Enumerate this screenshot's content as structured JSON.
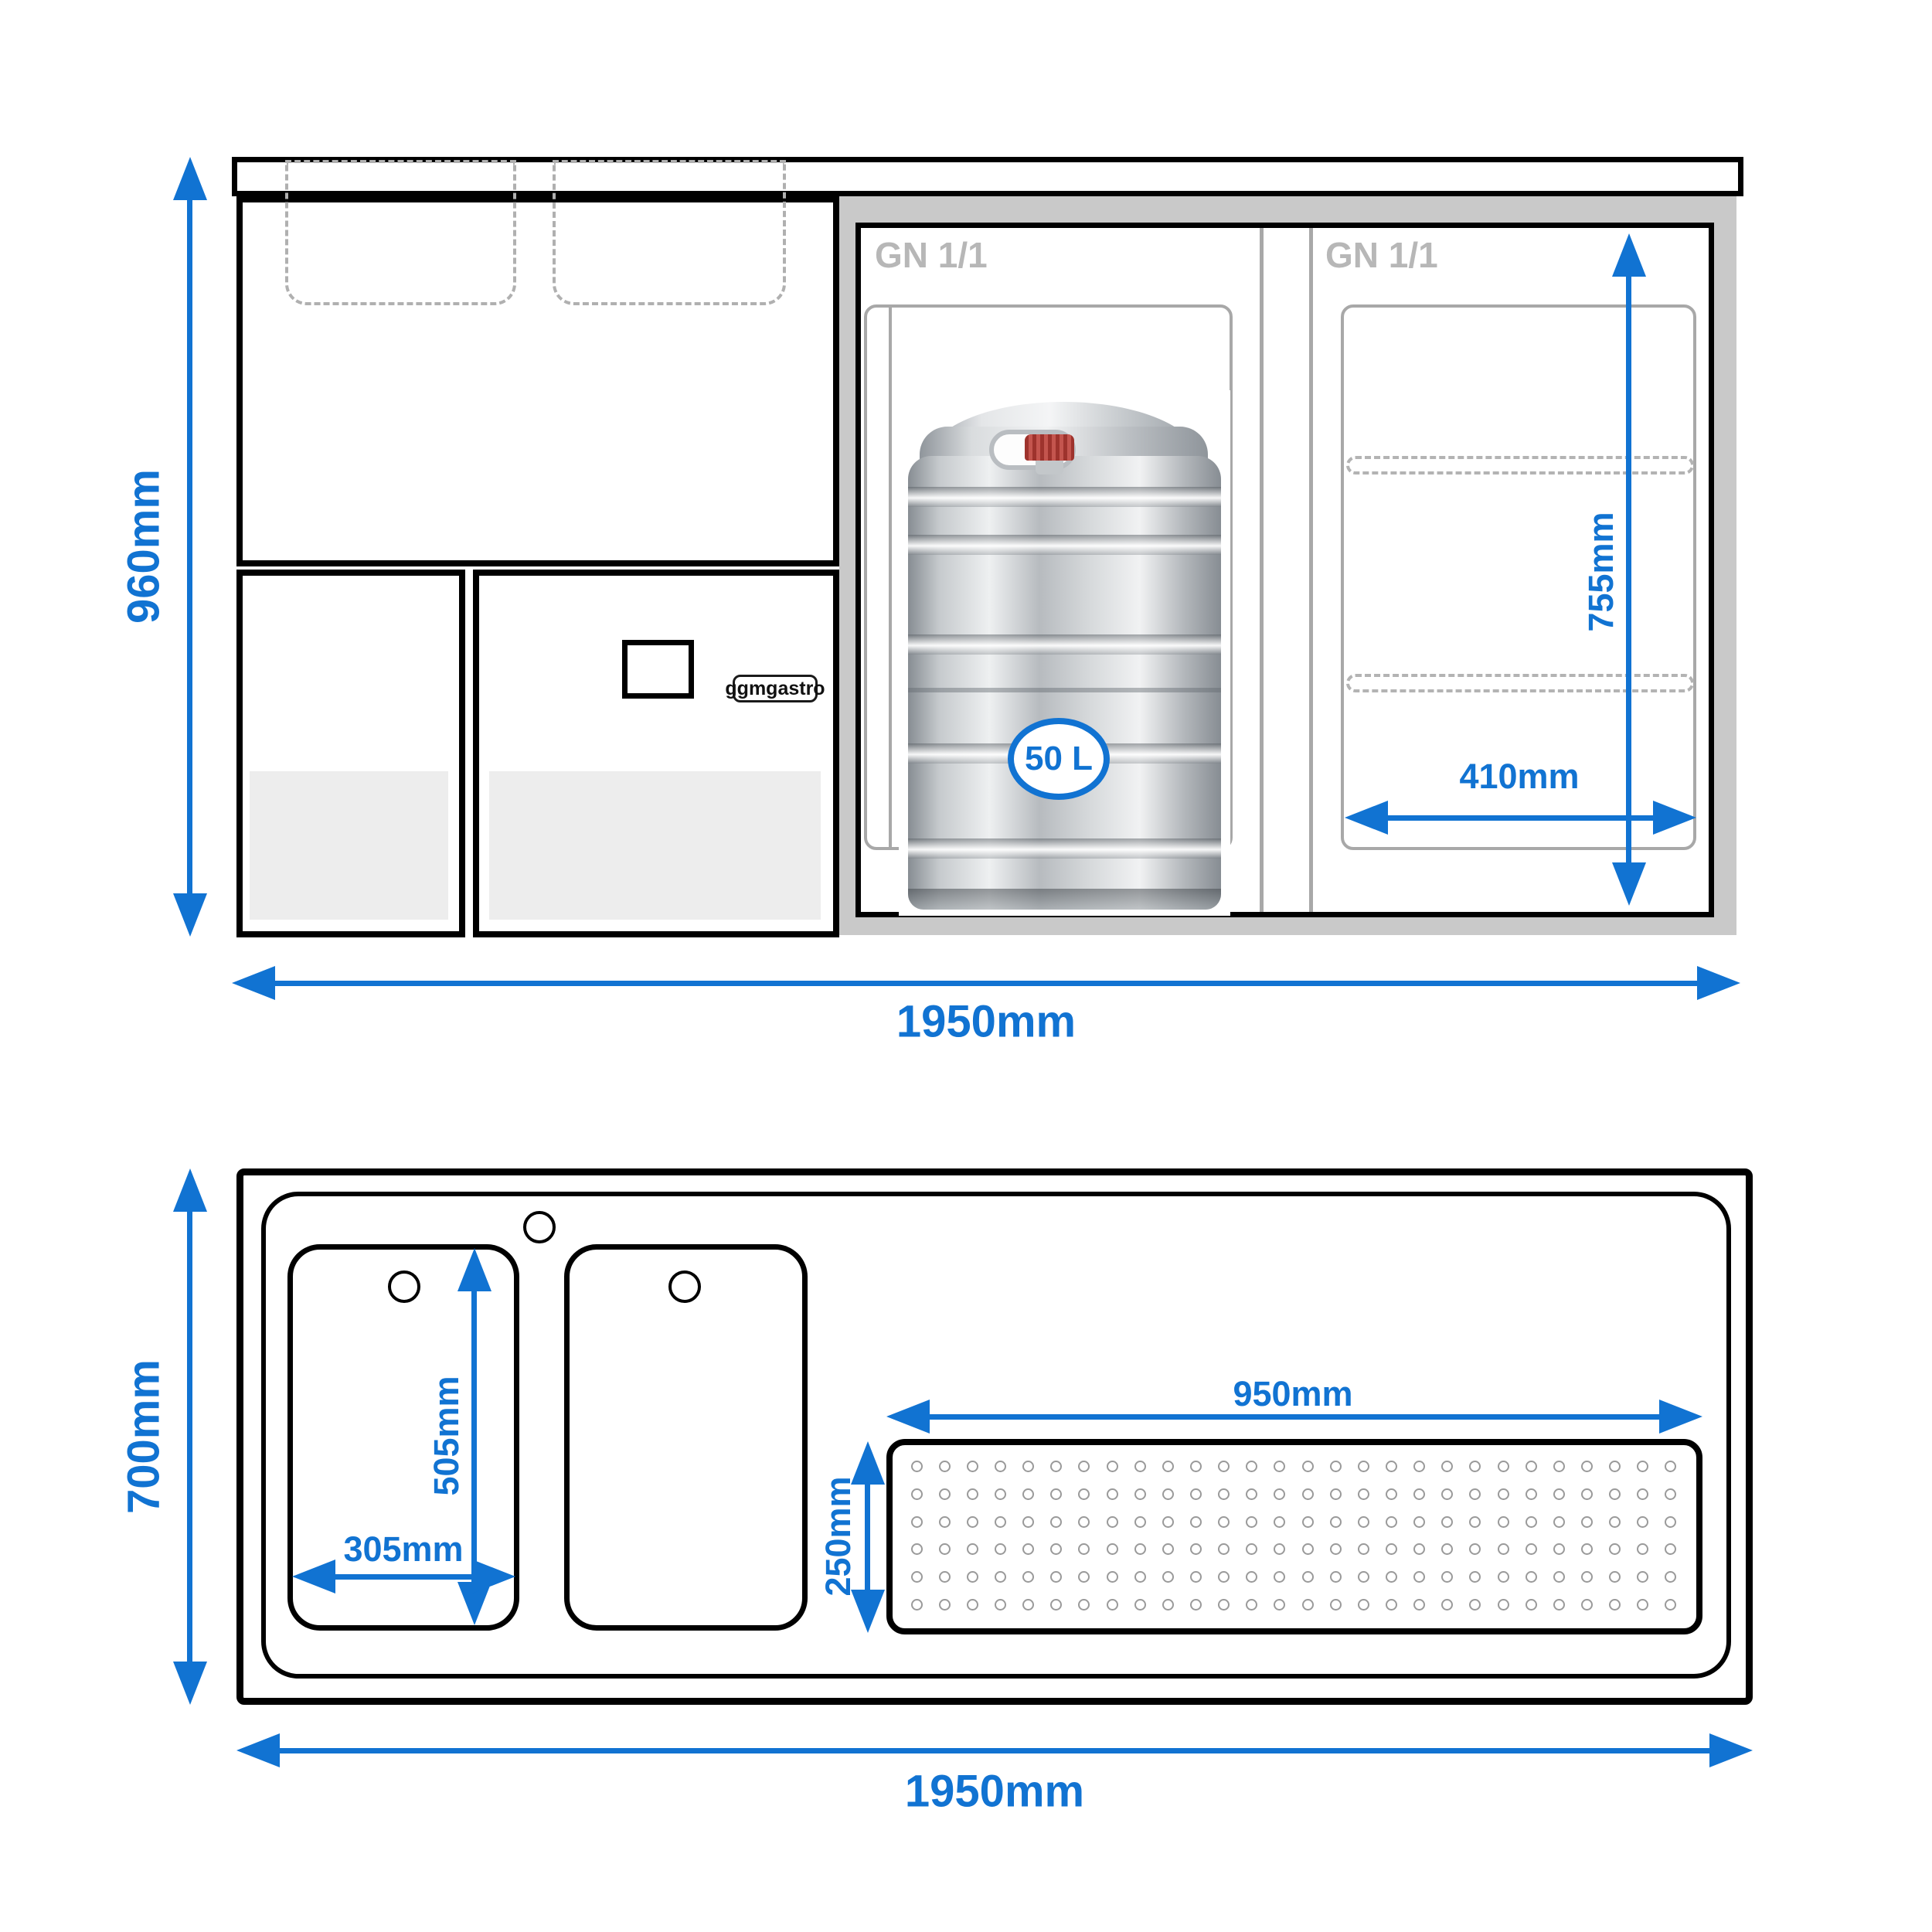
{
  "front_view": {
    "dim_height": "960mm",
    "dim_width": "1950mm",
    "dim_inner_height": "755mm",
    "dim_inner_width": "410mm",
    "gn_label_left": "GN 1/1",
    "gn_label_right": "GN 1/1",
    "keg_capacity": "50 L",
    "brand_label": "ggmgastro"
  },
  "top_view": {
    "dim_height": "700mm",
    "dim_width": "1950mm",
    "dim_sink_width": "305mm",
    "dim_sink_depth": "505mm",
    "dim_drainer_width": "950mm",
    "dim_drainer_depth": "250mm",
    "drainer_grid": {
      "rows": 6,
      "cols": 28
    }
  },
  "colors": {
    "dimension_blue": "#1173d2",
    "frame_gray": "#c9c9c9",
    "detail_gray": "#a8a8a8",
    "label_gray": "#b7b7b7",
    "keg_cap_red": "#9e332d"
  }
}
